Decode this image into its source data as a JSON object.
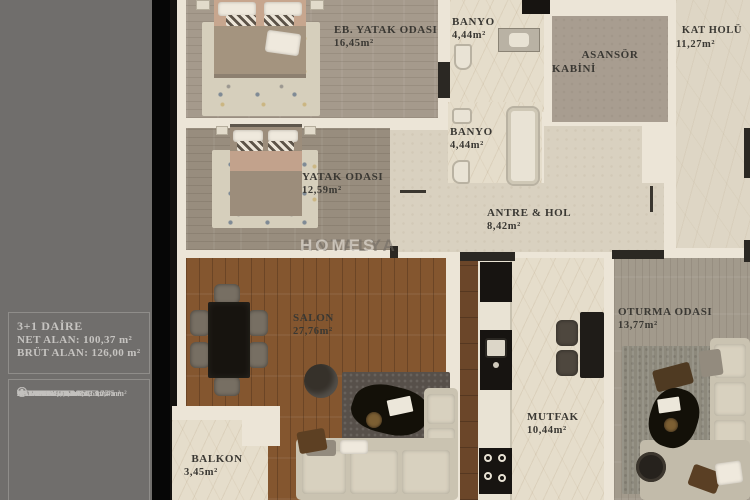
{
  "sidebar": {
    "title": "3+1 DAİRE",
    "net": "NET ALAN: 100,37  m²",
    "brut": "BRÜT ALAN: 126,00 m²",
    "items": [
      {
        "num": "1",
        "label": "ANTRE&HOL: 8,42 m²"
      },
      {
        "num": "2",
        "label": "OTURMA ODASI: 13,77 m²"
      },
      {
        "num": "3",
        "label": "MUTFAK: 10,44 m²"
      },
      {
        "num": "4",
        "label": "SALON: 27,76 m²"
      },
      {
        "num": "5",
        "label": "BALKON: 3,45"
      },
      {
        "num": "6",
        "label": "YATAK ODASI: 12,59 m²"
      },
      {
        "num": "7",
        "label": "EB. YATAK ODASI: 16,45 m²"
      },
      {
        "num": "8",
        "label": "BANYO: 4,44 m²"
      },
      {
        "num": "9",
        "label": "BANYO: 4,44 m²"
      }
    ]
  },
  "rooms": {
    "eb_yatak": {
      "name": "EB. YATAK ODASI",
      "area": "16,45m²"
    },
    "banyo_top": {
      "name": "BANYO",
      "area": "4,44m²"
    },
    "asansor": {
      "line1": "ASANSÖR",
      "line2": "KABİNİ"
    },
    "kat_holu": {
      "name": "KAT HOLÜ",
      "area": "11,27m²"
    },
    "yatak": {
      "name": "YATAK ODASI",
      "area": "12,59m²"
    },
    "banyo_mid": {
      "name": "BANYO",
      "area": "4,44m²"
    },
    "antre": {
      "name": "ANTRE & HOL",
      "area": "8,42m²"
    },
    "salon": {
      "name": "SALON",
      "area": "27,76m²"
    },
    "mutfak": {
      "name": "MUTFAK",
      "area": "10,44m²"
    },
    "oturma": {
      "name": "OTURMA ODASI",
      "area": "13,77m²"
    },
    "balkon": {
      "name": "BALKON",
      "area": "3,45m²"
    }
  },
  "watermark": {
    "text1": "ANTALYA",
    "text2": "HOMES"
  },
  "colors": {
    "sidebar_bg": "#706e6c",
    "sidebar_text": "#c6c4c1",
    "label_text": "#3a3833",
    "wall": "#ece5d7",
    "wall_core_black": "#2b2823",
    "wood_salon": "#84562f",
    "wood_bedroom": "#a59a8c",
    "wood_grey": "#a29a8c",
    "marble": "#ded6c5",
    "plaster": "#d9d1c0",
    "divider_black": "#060606"
  }
}
